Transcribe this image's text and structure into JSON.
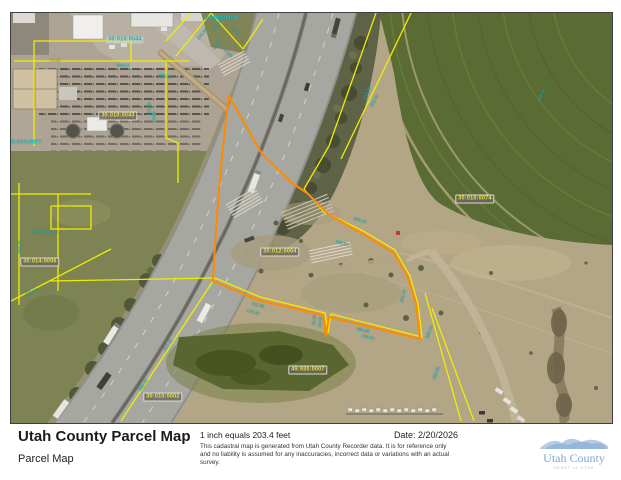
{
  "footer": {
    "title": "Utah County Parcel Map",
    "subtitle": "Parcel Map",
    "scale_text": "1 inch equals 203.4 feet",
    "date_label": "Date: 2/20/2026",
    "disclaimer": "This cadastral map is generated from Utah County Recorder data.  It is for reference only and no liability is assumed for any inaccuracies, incorrect data or variations with an actual survey.",
    "logo": {
      "name": "Utah County",
      "tagline": "HEART of UTAH"
    }
  },
  "colors": {
    "parcel_line": "#f2ed00",
    "highlight_parcel": "#ff8a00",
    "dimension_text": "#18d2de",
    "logo_blue": "#9dbedd"
  },
  "map": {
    "parcel_labels": [
      {
        "text": "30:010:0044",
        "x": 114,
        "y": 27,
        "style": "cyan-tag"
      },
      {
        "text": "30:010:0028",
        "x": 211,
        "y": 6,
        "style": "cyan"
      },
      {
        "text": "30:010:0043",
        "x": 107,
        "y": 103,
        "style": "tag"
      },
      {
        "text": "30:014:0077",
        "x": 14,
        "y": 130,
        "style": "cyan"
      },
      {
        "text": "30:014:0006",
        "x": 29,
        "y": 249,
        "style": "tag"
      },
      {
        "text": "30:012:0004",
        "x": 269,
        "y": 239,
        "style": "tag"
      },
      {
        "text": "30:010:0074",
        "x": 464,
        "y": 186,
        "style": "tag"
      },
      {
        "text": "49:930:0007",
        "x": 297,
        "y": 357,
        "style": "tag"
      },
      {
        "text": "30:010:0002",
        "x": 152,
        "y": 384,
        "style": "tag"
      }
    ],
    "dimension_labels": [
      {
        "text": "448.12",
        "x": 112,
        "y": 52,
        "rot": 0
      },
      {
        "text": "448.15",
        "x": 154,
        "y": 63,
        "rot": 8
      },
      {
        "text": "74.66",
        "x": 44,
        "y": 47,
        "rot": 0,
        "color": "yellow"
      },
      {
        "text": "270.34",
        "x": 191,
        "y": 21,
        "rot": -52
      },
      {
        "text": "94.07",
        "x": 206,
        "y": 12,
        "rot": -52
      },
      {
        "text": "75.06",
        "x": 224,
        "y": 17,
        "rot": 42
      },
      {
        "text": "44.06",
        "x": 206,
        "y": 32,
        "rot": -52
      },
      {
        "text": "47.99",
        "x": 217,
        "y": 40,
        "rot": 42
      },
      {
        "text": "443.75",
        "x": 356,
        "y": 80,
        "rot": -62
      },
      {
        "text": "443.78",
        "x": 363,
        "y": 88,
        "rot": -62
      },
      {
        "text": "443.74",
        "x": 530,
        "y": 82,
        "rot": -62
      },
      {
        "text": "117.50",
        "x": 138,
        "y": 96,
        "rot": -88
      },
      {
        "text": "82.36",
        "x": 143,
        "y": 104,
        "rot": -88
      },
      {
        "text": "105.64",
        "x": 27,
        "y": 219,
        "rot": 0
      },
      {
        "text": "204.41",
        "x": 41,
        "y": 219,
        "rot": 0
      },
      {
        "text": "203.19",
        "x": 9,
        "y": 234,
        "rot": -88
      },
      {
        "text": "175.35",
        "x": 20,
        "y": 279,
        "rot": -20
      },
      {
        "text": "205.19",
        "x": 349,
        "y": 207,
        "rot": 16
      },
      {
        "text": "206.84",
        "x": 331,
        "y": 230,
        "rot": 16
      },
      {
        "text": "202.04",
        "x": 392,
        "y": 283,
        "rot": -75
      },
      {
        "text": "211.98",
        "x": 247,
        "y": 292,
        "rot": 14
      },
      {
        "text": "179.32",
        "x": 242,
        "y": 299,
        "rot": 14
      },
      {
        "text": "206.83",
        "x": 352,
        "y": 317,
        "rot": 12
      },
      {
        "text": "203.62",
        "x": 357,
        "y": 324,
        "rot": 12
      },
      {
        "text": "36.04",
        "x": 303,
        "y": 307,
        "rot": -85
      },
      {
        "text": "39.06",
        "x": 309,
        "y": 309,
        "rot": -85
      },
      {
        "text": "377.71",
        "x": 157,
        "y": 332,
        "rot": -55
      },
      {
        "text": "362.74",
        "x": 132,
        "y": 372,
        "rot": -55
      },
      {
        "text": "305.41",
        "x": 418,
        "y": 319,
        "rot": -70
      },
      {
        "text": "258.63",
        "x": 425,
        "y": 360,
        "rot": -70
      }
    ]
  }
}
